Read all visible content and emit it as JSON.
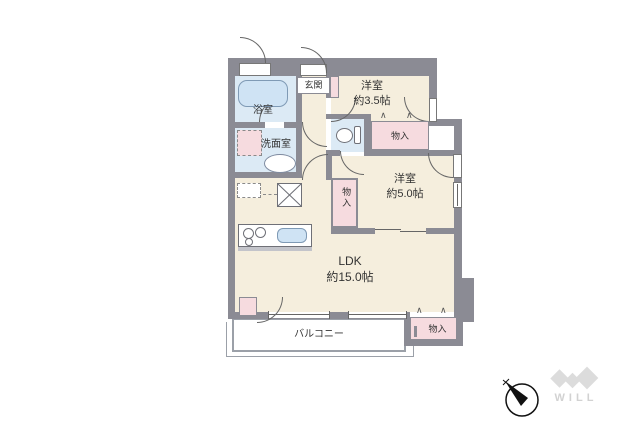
{
  "rooms": {
    "genkan": {
      "label": "玄関"
    },
    "bath": {
      "label": "浴室"
    },
    "washroom": {
      "label": "洗面室"
    },
    "western_small": {
      "label": "洋室",
      "size": "約3.5帖"
    },
    "western_mid": {
      "label": "洋室",
      "size": "約5.0帖"
    },
    "ldk": {
      "label": "LDK",
      "size": "約15.0帖"
    },
    "balcony": {
      "label": "バルコニー"
    }
  },
  "closets": {
    "closet_small_room": {
      "label": "物入"
    },
    "closet_mid_room": {
      "label": "物入"
    },
    "closet_ldk": {
      "label": "物入"
    }
  },
  "icons": {
    "folding_door_glyph": "∧"
  },
  "branding": {
    "logo_text": "WILL"
  },
  "colors": {
    "wall": "#8b8b94",
    "room_floor": "#f5eedd",
    "wet_area": "#dceaf5",
    "storage_pink": "#f6dbdf",
    "fixture_blue": "#cfe3f4",
    "balcony_border": "#9ba0a8",
    "logo_gray": "#d8d8d8"
  }
}
